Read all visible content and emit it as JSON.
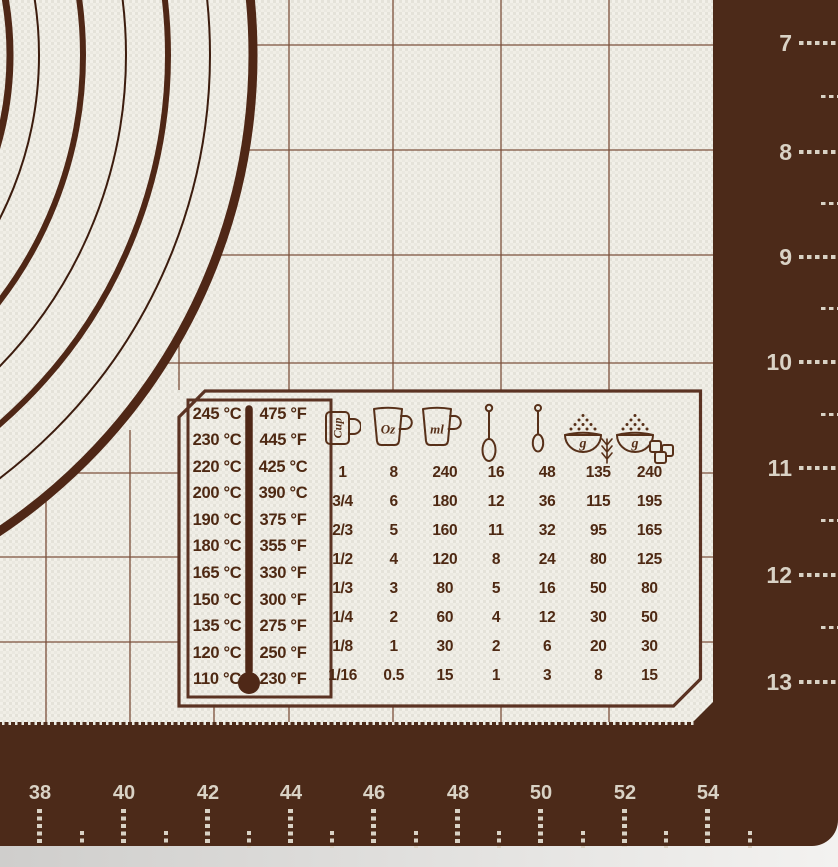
{
  "colors": {
    "mat_border": "#4c2a19",
    "mat_surface": "#ecebe3",
    "print_brown": "#53301c",
    "grid_line": "#70402a",
    "ruler_text": "#d9d2c5",
    "photo_background": "#d9d8d6"
  },
  "temperature_table": {
    "rows": [
      {
        "c": "245 °C",
        "f": "475 °F"
      },
      {
        "c": "230 °C",
        "f": "445 °F"
      },
      {
        "c": "220 °C",
        "f": "425 °C"
      },
      {
        "c": "200 °C",
        "f": "390 °C"
      },
      {
        "c": "190 °C",
        "f": "375 °F"
      },
      {
        "c": "180 °C",
        "f": "355 °F"
      },
      {
        "c": "165 °C",
        "f": "330 °F"
      },
      {
        "c": "150 °C",
        "f": "300 °F"
      },
      {
        "c": "135 °C",
        "f": "275 °F"
      },
      {
        "c": "120 °C",
        "f": "250 °F"
      },
      {
        "c": "110 °C",
        "f": "230 °F"
      }
    ]
  },
  "conversion_table": {
    "header_icons": [
      "cup",
      "oz-jug",
      "ml-jug",
      "tablespoon",
      "teaspoon",
      "flour-grams",
      "sugar-grams"
    ],
    "cup_label": "Cup",
    "oz_label": "Oz",
    "ml_label": "ml",
    "flour_label": "g",
    "sugar_label": "g",
    "rows": [
      [
        "1",
        "8",
        "240",
        "16",
        "48",
        "135",
        "240"
      ],
      [
        "3/4",
        "6",
        "180",
        "12",
        "36",
        "115",
        "195"
      ],
      [
        "2/3",
        "5",
        "160",
        "11",
        "32",
        "95",
        "165"
      ],
      [
        "1/2",
        "4",
        "120",
        "8",
        "24",
        "80",
        "125"
      ],
      [
        "1/3",
        "3",
        "80",
        "5",
        "16",
        "50",
        "80"
      ],
      [
        "1/4",
        "2",
        "60",
        "4",
        "12",
        "30",
        "50"
      ],
      [
        "1/8",
        "1",
        "30",
        "2",
        "6",
        "20",
        "30"
      ],
      [
        "1/16",
        "0.5",
        "15",
        "1",
        "3",
        "8",
        "15"
      ]
    ]
  },
  "right_ruler": {
    "labels": [
      "7",
      "8",
      "9",
      "10",
      "11",
      "12",
      "13"
    ]
  },
  "bottom_ruler": {
    "labels": [
      "38",
      "40",
      "42",
      "44",
      "46",
      "48",
      "50",
      "52",
      "54"
    ]
  }
}
